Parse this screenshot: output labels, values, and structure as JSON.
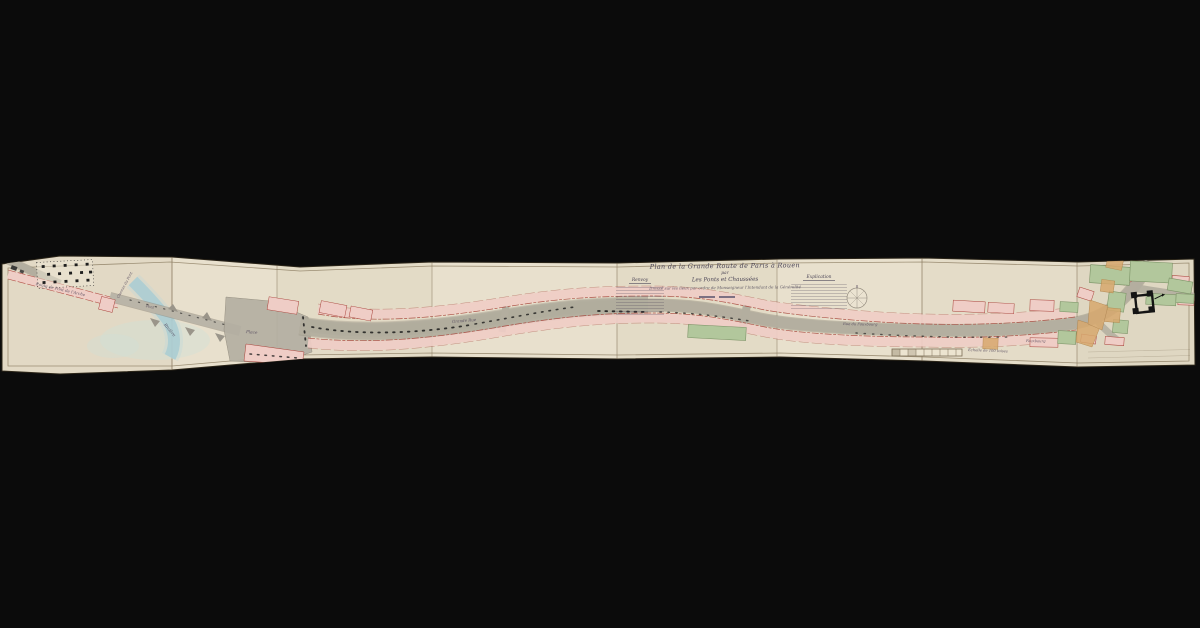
{
  "map": {
    "title": {
      "line1": "Plan de la Grande Route de Paris à Rouen",
      "par": "par",
      "line2": "Les Ponts et Chaussées",
      "line3": "Dressé sur les lieux par ordre de Monseigneur l'Intendant de la Généralité"
    },
    "legend_left": {
      "heading": "Renvoy"
    },
    "legend_right": {
      "heading": "Explication"
    },
    "labels": [
      {
        "text": "Route de Pont de l'Arche"
      },
      {
        "text": "Chemin du Pont"
      },
      {
        "text": "Pont"
      },
      {
        "text": "Rivière"
      },
      {
        "text": "Place"
      },
      {
        "text": "Grande Rue"
      },
      {
        "text": "Rue du Fauxbourg"
      },
      {
        "text": "Fauxbourg"
      },
      {
        "text": "Échelle de 100 toises"
      }
    ],
    "colors": {
      "background": "#0b0b0b",
      "paper": "#e8e0cd",
      "building_pink": "#efcdc6",
      "building_edge_red": "#a8423a",
      "road_gray": "#b3ae9f",
      "water_blue": "#a9ccd2",
      "garden_green": "#b2c79c",
      "field_tan": "#d8a96e",
      "ink": "#4a4456"
    }
  }
}
